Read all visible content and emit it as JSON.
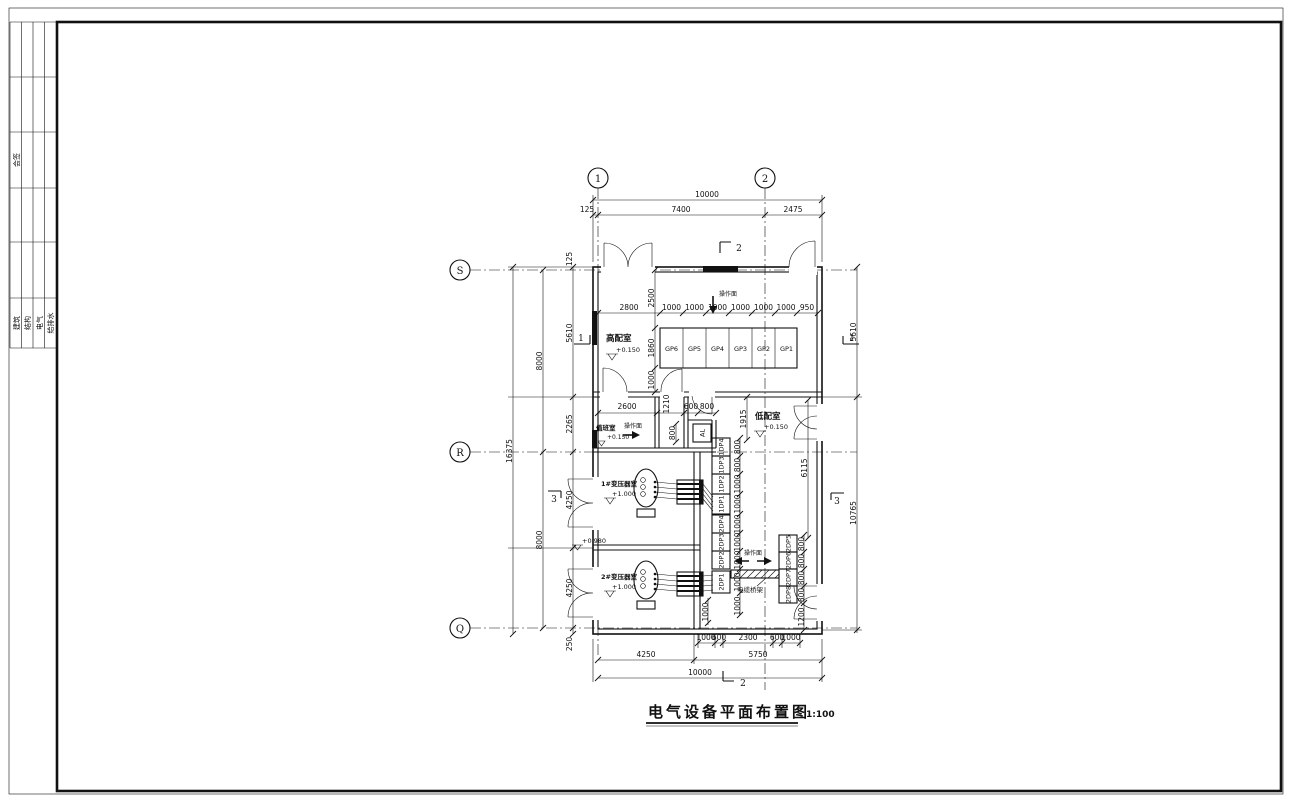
{
  "sheet": {
    "title": "电气设备平面布置图",
    "scale": "1:100"
  },
  "title_block": {
    "sign": "会签",
    "disciplines": [
      "建筑",
      "结构",
      "电气",
      "给排水"
    ]
  },
  "grid": {
    "cols": [
      "1",
      "2"
    ],
    "rows": [
      "S",
      "R",
      "Q"
    ]
  },
  "rooms": {
    "hv": {
      "name": "高配室",
      "elev": "+0.150"
    },
    "duty": {
      "name": "值班室",
      "elev": "+0.150"
    },
    "lv": {
      "name": "低配室",
      "elev": "+0.150"
    },
    "t1": {
      "name": "1#变压器室",
      "elev": "+1.000"
    },
    "t2": {
      "name": "2#变压器室",
      "elev": "+1.000"
    },
    "wall": {
      "elev": "+0.980"
    }
  },
  "panels": {
    "gp": [
      "GP6",
      "GP5",
      "GP4",
      "GP3",
      "GP2",
      "GP1"
    ],
    "dp": [
      "1DP4",
      "1DP3",
      "1DP2",
      "1DP1",
      "2DP4",
      "2DP3",
      "2DP2",
      "2DP1"
    ],
    "dp2": [
      "2DP5",
      "2DP6",
      "2DP7",
      "2DP8"
    ],
    "al": "AL"
  },
  "notes": {
    "op": "操作面",
    "tray": "电缆桥架"
  },
  "sections": {
    "s1": "1",
    "s2": "2",
    "s3": "3"
  },
  "dims": {
    "top": [
      "10000",
      "125",
      "7400",
      "2475"
    ],
    "left": {
      "outer": "16375",
      "mid": [
        "8000",
        "8000"
      ],
      "inner": [
        "125",
        "5610",
        "2265",
        "4250",
        "4250",
        "250"
      ]
    },
    "right": [
      "5610",
      "10765"
    ],
    "hv_row": [
      "2800",
      "1000",
      "1000",
      "1000",
      "1000",
      "1000",
      "1000",
      "950"
    ],
    "hv_col": [
      "2500",
      "1860",
      "1000"
    ],
    "band": [
      "2600",
      "1210",
      "600",
      "800"
    ],
    "band_v": "800",
    "lv": [
      "1915",
      "6115"
    ],
    "dp": [
      "800",
      "800",
      "1000",
      "1000",
      "1000",
      "1000",
      "1000",
      "1000",
      "1000"
    ],
    "dp2": [
      "800",
      "800",
      "800",
      "800",
      "1200"
    ],
    "bottom1": [
      "1000",
      "600",
      "2300",
      "600",
      "1000"
    ],
    "bottom2": [
      "4250",
      "5750"
    ],
    "bottom3": "10000",
    "inner": "1000"
  }
}
